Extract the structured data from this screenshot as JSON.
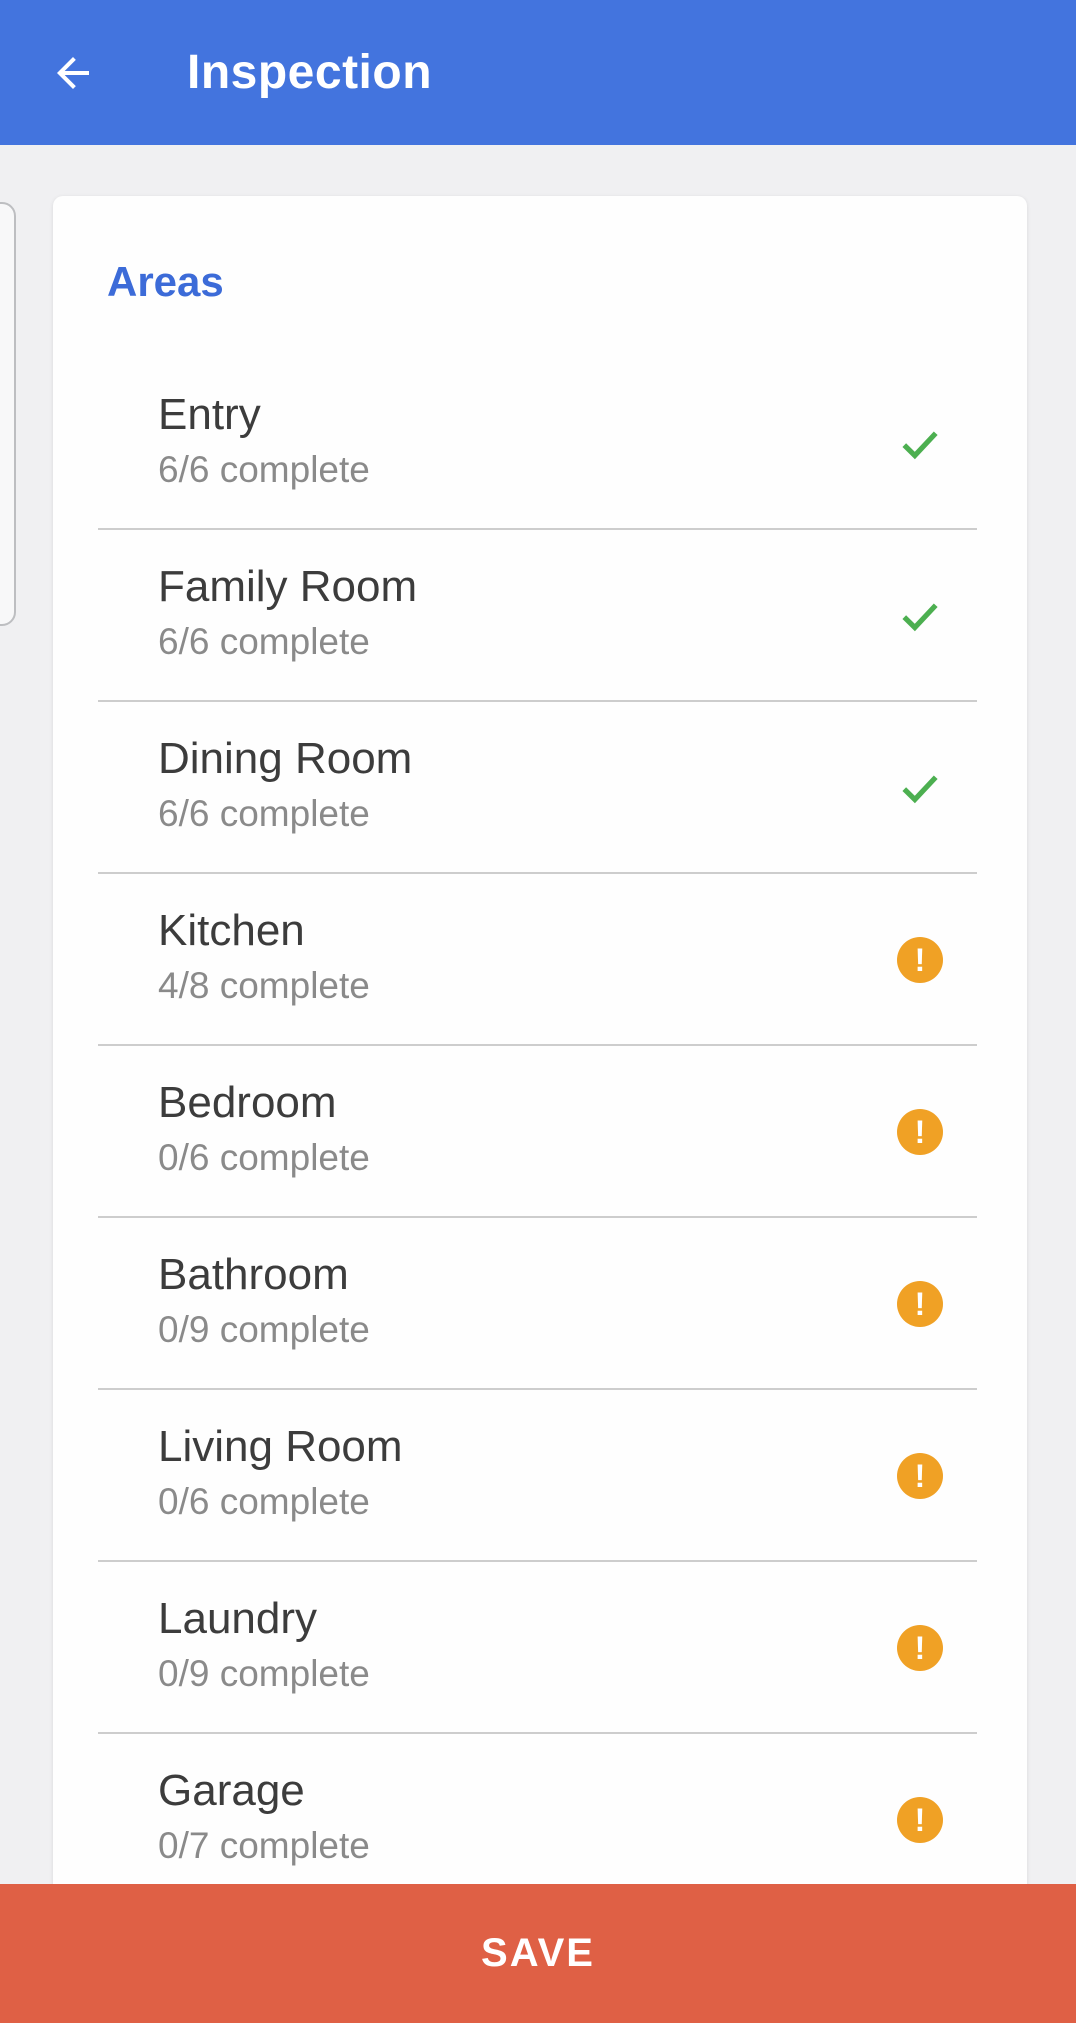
{
  "header": {
    "title": "Inspection"
  },
  "areas": {
    "heading": "Areas",
    "items": [
      {
        "name": "Entry",
        "progress": "6/6 complete",
        "status": "complete"
      },
      {
        "name": "Family Room",
        "progress": "6/6 complete",
        "status": "complete"
      },
      {
        "name": "Dining Room",
        "progress": "6/6 complete",
        "status": "complete"
      },
      {
        "name": "Kitchen",
        "progress": "4/8 complete",
        "status": "incomplete"
      },
      {
        "name": "Bedroom",
        "progress": "0/6 complete",
        "status": "incomplete"
      },
      {
        "name": "Bathroom",
        "progress": "0/9 complete",
        "status": "incomplete"
      },
      {
        "name": "Living Room",
        "progress": "0/6 complete",
        "status": "incomplete"
      },
      {
        "name": "Laundry",
        "progress": "0/9 complete",
        "status": "incomplete"
      },
      {
        "name": "Garage",
        "progress": "0/7 complete",
        "status": "incomplete"
      }
    ]
  },
  "icons": {
    "back": "arrow-left-icon",
    "complete": "check-icon",
    "incomplete": "warning-exclamation-icon",
    "warning_glyph": "!"
  },
  "save_bar": {
    "label": "SAVE"
  },
  "colors": {
    "app_bar": "#4374DE",
    "heading_blue": "#3C6BD8",
    "check_green": "#4CAF50",
    "warning_orange": "#F0A125",
    "save_red": "#DF6045",
    "background": "#F0F0F2",
    "card": "#FEFEFE"
  }
}
